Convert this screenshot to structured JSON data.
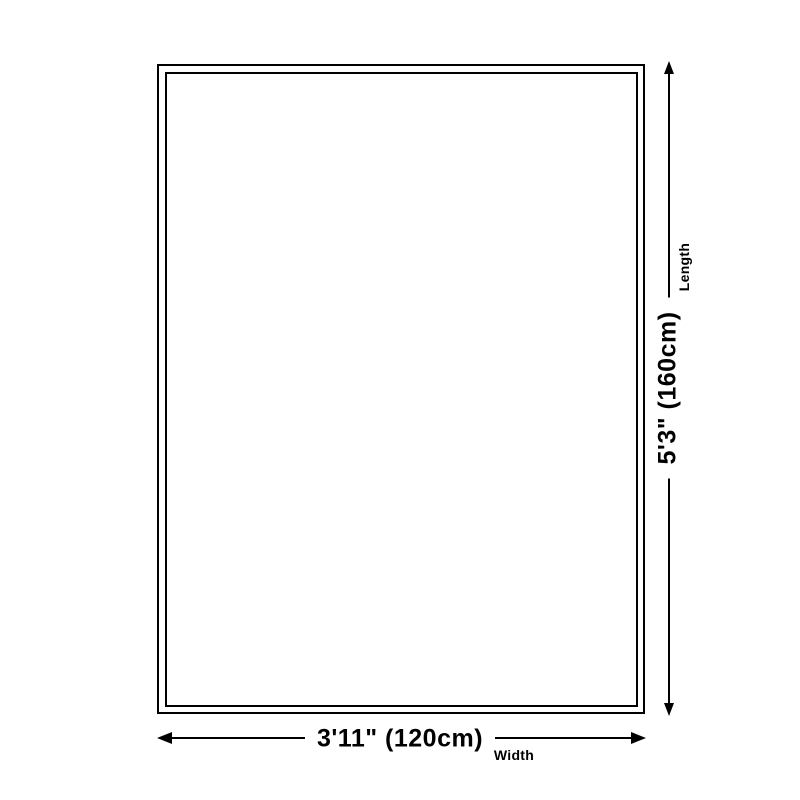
{
  "page": {
    "background_color": "#ffffff",
    "line_color": "#000000",
    "description": "Rug size dimension diagram"
  },
  "diagram": {
    "rug": {
      "shape": "rectangle",
      "border_style": "double",
      "fill_color": "#ffffff",
      "border_color": "#000000"
    },
    "length": {
      "value": "5'3\" (160cm)",
      "label": "Length",
      "arrow": "double-headed-vertical"
    },
    "width": {
      "value": "3'11\" (120cm)",
      "label": "Width",
      "arrow": "double-headed-horizontal"
    }
  }
}
